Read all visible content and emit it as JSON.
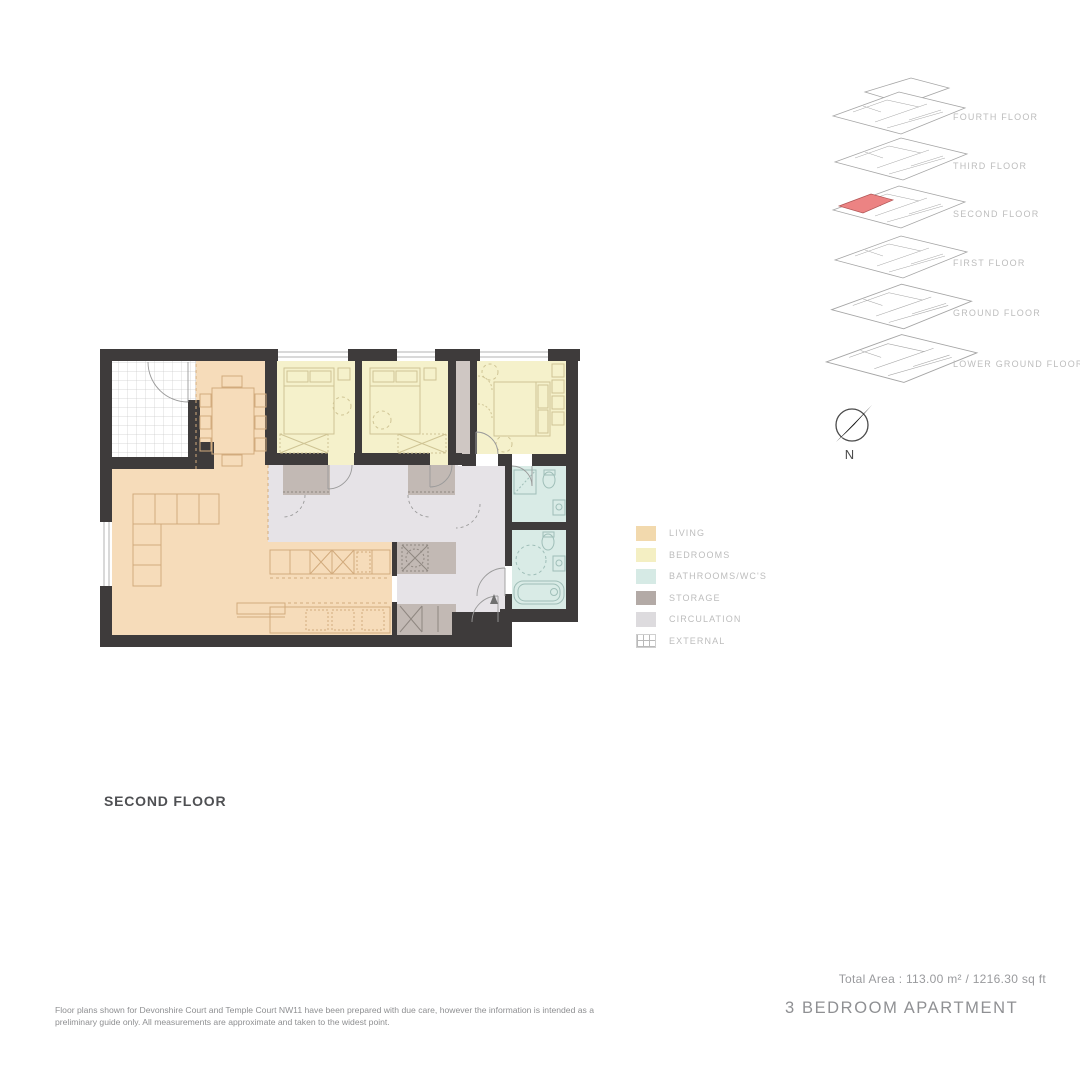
{
  "plan": {
    "title": "SECOND FLOOR",
    "rooms": [
      "living-dining",
      "kitchen",
      "bedroom-1",
      "bedroom-2",
      "bedroom-3",
      "ensuite-bathroom",
      "main-bathroom",
      "storage",
      "hallway",
      "balcony"
    ]
  },
  "colors": {
    "walls": "#3e3b3b",
    "living": "#f6dcba",
    "bedrooms": "#f5f1cb",
    "bathrooms": "#d9ebe6",
    "storage": "#c2b9b4",
    "circulation": "#e6e3e7",
    "external": "#ffffff",
    "highlight": "#ec8383",
    "living_furniture": "#d2ab7d",
    "bedroom_furniture": "#cfc494",
    "bath_fixture": "#9fbeb8",
    "door_arc": "#9a9a9a",
    "stack_line": "#a5a5a5"
  },
  "legend": {
    "items": [
      {
        "label": "LIVING",
        "color": "#f2d9ad",
        "pattern": "solid"
      },
      {
        "label": "BEDROOMS",
        "color": "#f4efc3",
        "pattern": "solid"
      },
      {
        "label": "BATHROOMS/WC'S",
        "color": "#d6eae5",
        "pattern": "solid"
      },
      {
        "label": "STORAGE",
        "color": "#b3aaa6",
        "pattern": "solid"
      },
      {
        "label": "CIRCULATION",
        "color": "#dddbde",
        "pattern": "solid"
      },
      {
        "label": "EXTERNAL",
        "color": "#ffffff",
        "pattern": "grid"
      }
    ]
  },
  "floor_stack": {
    "highlighted_floor": "SECOND FLOOR",
    "floors": [
      {
        "label": "FOURTH FLOOR"
      },
      {
        "label": "THIRD FLOOR"
      },
      {
        "label": "SECOND FLOOR"
      },
      {
        "label": "FIRST FLOOR"
      },
      {
        "label": "GROUND FLOOR"
      },
      {
        "label": "LOWER GROUND FLOOR"
      }
    ]
  },
  "compass": {
    "label": "N"
  },
  "summary": {
    "total_area": "Total Area : 113.00 m² / 1216.30 sq ft",
    "apartment_type": "3 BEDROOM  APARTMENT"
  },
  "disclaimer": {
    "text": "Floor plans shown for Devonshire Court and Temple Court NW11 have been prepared with due care, however the information is intended as a preliminary guide only. All measurements are approximate and taken to the widest point."
  }
}
